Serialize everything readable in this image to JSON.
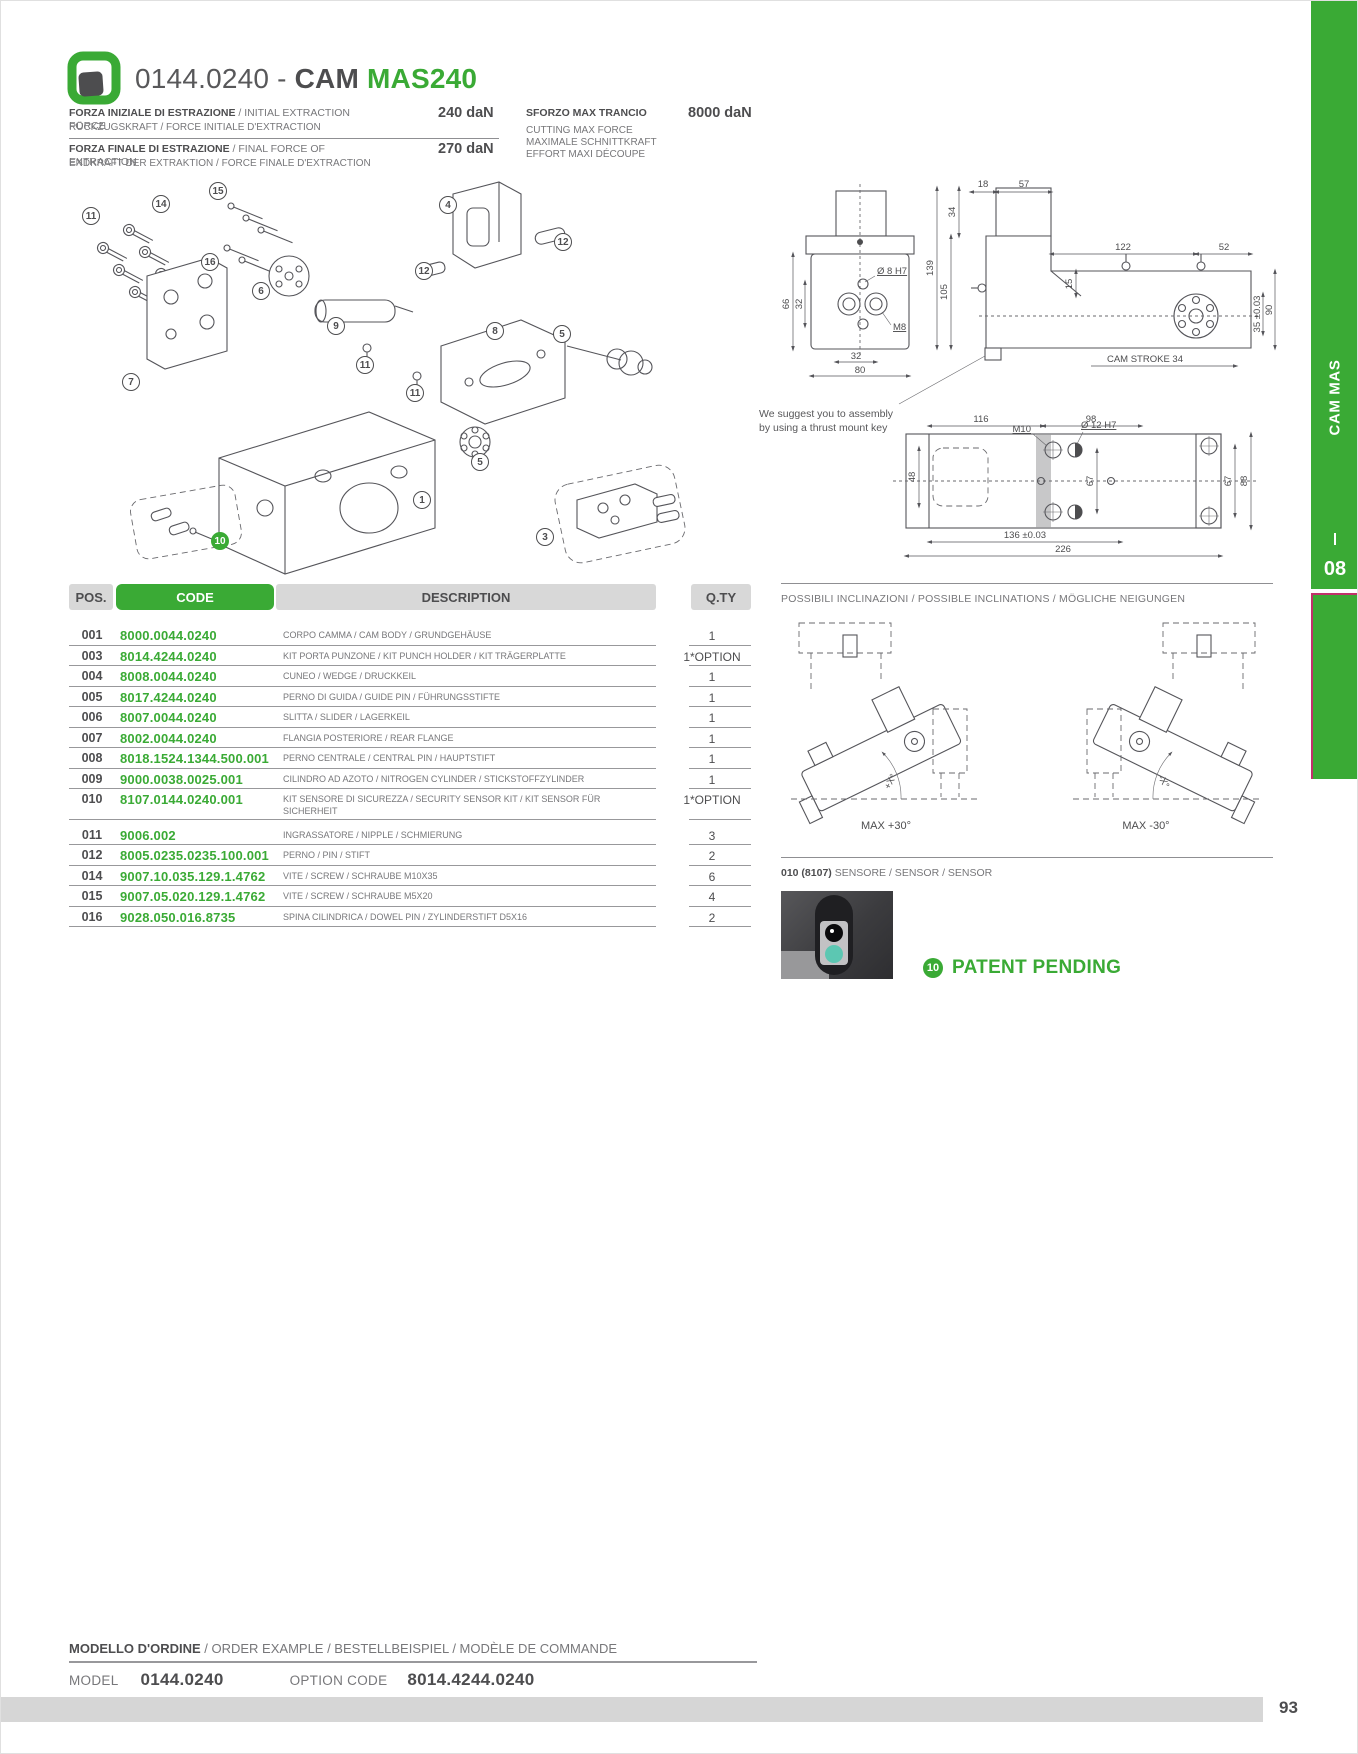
{
  "header": {
    "code": "0144.0240 - ",
    "cam": "CAM ",
    "model": "MAS240"
  },
  "specs": {
    "rows": [
      {
        "main": "FORZA INIZIALE DI ESTRAZIONE",
        "main_rest": " / INITIAL EXTRACTION FORCE",
        "sub": "RÜCKZUGSKRAFT / FORCE INITIALE D'EXTRACTION",
        "value": "240 daN"
      },
      {
        "main": "FORZA FINALE DI ESTRAZIONE",
        "main_rest": " / FINAL FORCE OF EXTRACTION",
        "sub": "ENDKRAFT DER EXTRAKTION / FORCE FINALE D'EXTRACTION",
        "value": "270 daN"
      }
    ],
    "max_force": {
      "title": "SFORZO MAX TRANCIO",
      "value": "8000 daN",
      "lines": [
        "CUTTING MAX FORCE",
        "MAXIMALE SCHNITTKRAFT",
        "EFFORT MAXI DÉCOUPE"
      ]
    }
  },
  "assembly_note": {
    "line1": "We suggest you to assembly",
    "line2": "by using a thrust mount key"
  },
  "dims": {
    "front_h": "66",
    "front_inner": "32",
    "front_hole": "Ø 8 H7",
    "front_thread": "M8",
    "front_w1": "32",
    "front_w2": "80",
    "side_18": "18",
    "side_57": "57",
    "side_34": "34",
    "side_139": "139",
    "side_105": "105",
    "side_122": "122",
    "side_52": "52",
    "side_15": "15",
    "side_35": "35 ±0.03",
    "side_90": "90",
    "cam_stroke": "CAM STROKE 34",
    "plan_116": "116",
    "plan_98": "98",
    "plan_m10": "M10",
    "plan_12h7": "Ø 12 H7",
    "plan_48": "48",
    "plan_67a": "67",
    "plan_67b": "67",
    "plan_88": "88",
    "plan_136": "136 ±0.03",
    "plan_226": "226"
  },
  "exploded": {
    "balloons": [
      {
        "n": "11",
        "x": 22,
        "y": 40
      },
      {
        "n": "14",
        "x": 92,
        "y": 28
      },
      {
        "n": "15",
        "x": 149,
        "y": 15
      },
      {
        "n": "16",
        "x": 141,
        "y": 86
      },
      {
        "n": "6",
        "x": 192,
        "y": 115
      },
      {
        "n": "4",
        "x": 379,
        "y": 29
      },
      {
        "n": "12",
        "x": 494,
        "y": 66
      },
      {
        "n": "12",
        "x": 355,
        "y": 95
      },
      {
        "n": "9",
        "x": 267,
        "y": 150
      },
      {
        "n": "8",
        "x": 426,
        "y": 155
      },
      {
        "n": "5",
        "x": 493,
        "y": 158
      },
      {
        "n": "11",
        "x": 296,
        "y": 189
      },
      {
        "n": "11",
        "x": 346,
        "y": 217
      },
      {
        "n": "7",
        "x": 62,
        "y": 206
      },
      {
        "n": "5",
        "x": 411,
        "y": 286
      },
      {
        "n": "1",
        "x": 353,
        "y": 324
      },
      {
        "n": "3",
        "x": 476,
        "y": 361
      },
      {
        "n": "10",
        "x": 151,
        "y": 365,
        "accent": true
      }
    ]
  },
  "table": {
    "headers": {
      "pos": "POS.",
      "code": "CODE",
      "description": "DESCRIPTION",
      "qty": "Q.TY"
    },
    "rows": [
      {
        "pos": "001",
        "code": "8000.0044.0240",
        "desc": "CORPO CAMMA / CAM BODY / GRUNDGEHÄUSE",
        "qty": "1"
      },
      {
        "pos": "003",
        "code": "8014.4244.0240",
        "desc": "KIT PORTA PUNZONE / KIT PUNCH HOLDER / KIT TRÄGERPLATTE",
        "qty": "1*OPTION"
      },
      {
        "pos": "004",
        "code": "8008.0044.0240",
        "desc": "CUNEO / WEDGE / DRUCKKEIL",
        "qty": "1"
      },
      {
        "pos": "005",
        "code": "8017.4244.0240",
        "desc": "PERNO DI GUIDA / GUIDE PIN / FÜHRUNGSSTIFTE",
        "qty": "1"
      },
      {
        "pos": "006",
        "code": "8007.0044.0240",
        "desc": "SLITTA / SLIDER / LAGERKEIL",
        "qty": "1"
      },
      {
        "pos": "007",
        "code": "8002.0044.0240",
        "desc": "FLANGIA POSTERIORE / REAR FLANGE",
        "qty": "1"
      },
      {
        "pos": "008",
        "code": "8018.1524.1344.500.001",
        "desc": "PERNO CENTRALE / CENTRAL PIN / HAUPTSTIFT",
        "qty": "1"
      },
      {
        "pos": "009",
        "code": "9000.0038.0025.001",
        "desc": "CILINDRO AD AZOTO / NITROGEN CYLINDER / STICKSTOFFZYLINDER",
        "qty": "1"
      },
      {
        "pos": "010",
        "code": "8107.0144.0240.001",
        "desc": "KIT SENSORE DI SICUREZZA / SECURITY SENSOR KIT / KIT SENSOR FÜR SICHERHEIT",
        "qty": "1*OPTION",
        "group_end": true
      },
      {
        "pos": "011",
        "code": "9006.002",
        "desc": "INGRASSATORE / NIPPLE / SCHMIERUNG",
        "qty": "3"
      },
      {
        "pos": "012",
        "code": "8005.0235.0235.100.001",
        "desc": "PERNO / PIN / STIFT",
        "qty": "2"
      },
      {
        "pos": "014",
        "code": "9007.10.035.129.1.4762",
        "desc": "VITE / SCREW / SCHRAUBE M10X35",
        "qty": "6"
      },
      {
        "pos": "015",
        "code": "9007.05.020.129.1.4762",
        "desc": "VITE / SCREW / SCHRAUBE M5X20",
        "qty": "4"
      },
      {
        "pos": "016",
        "code": "9028.050.016.8735",
        "desc": "SPINA CILINDRICA / DOWEL PIN / ZYLINDERSTIFT D5X16",
        "qty": "2"
      }
    ]
  },
  "inclinations": {
    "title": "POSSIBILI INCLINAZIONI / POSSIBLE INCLINATIONS / MÖGLICHE NEIGUNGEN",
    "left_caption": "MAX +30°",
    "right_caption": "MAX -30°",
    "left_angle": "+X°",
    "right_angle": "-X°"
  },
  "sensor": {
    "ref": "010 (8107)",
    "label": " SENSORE / SENSOR / SENSOR"
  },
  "patent": {
    "badge": "10",
    "text": "PATENT PENDING"
  },
  "order": {
    "title": "MODELLO D'ORDINE",
    "title_rest": " / ORDER EXAMPLE / BESTELLBEISPIEL / MODÈLE DE COMMANDE",
    "model_label": "MODEL",
    "model_value": "0144.0240",
    "option_label": "OPTION CODE",
    "option_value": "8014.4244.0240"
  },
  "side_tab": {
    "label": "CAM MAS",
    "chapter": "08"
  },
  "page": {
    "number": "93"
  },
  "colors": {
    "green": "#3aaa35",
    "dark": "#4d4d4f",
    "grey": "#77777a",
    "accent_pink": "#c0316a"
  }
}
